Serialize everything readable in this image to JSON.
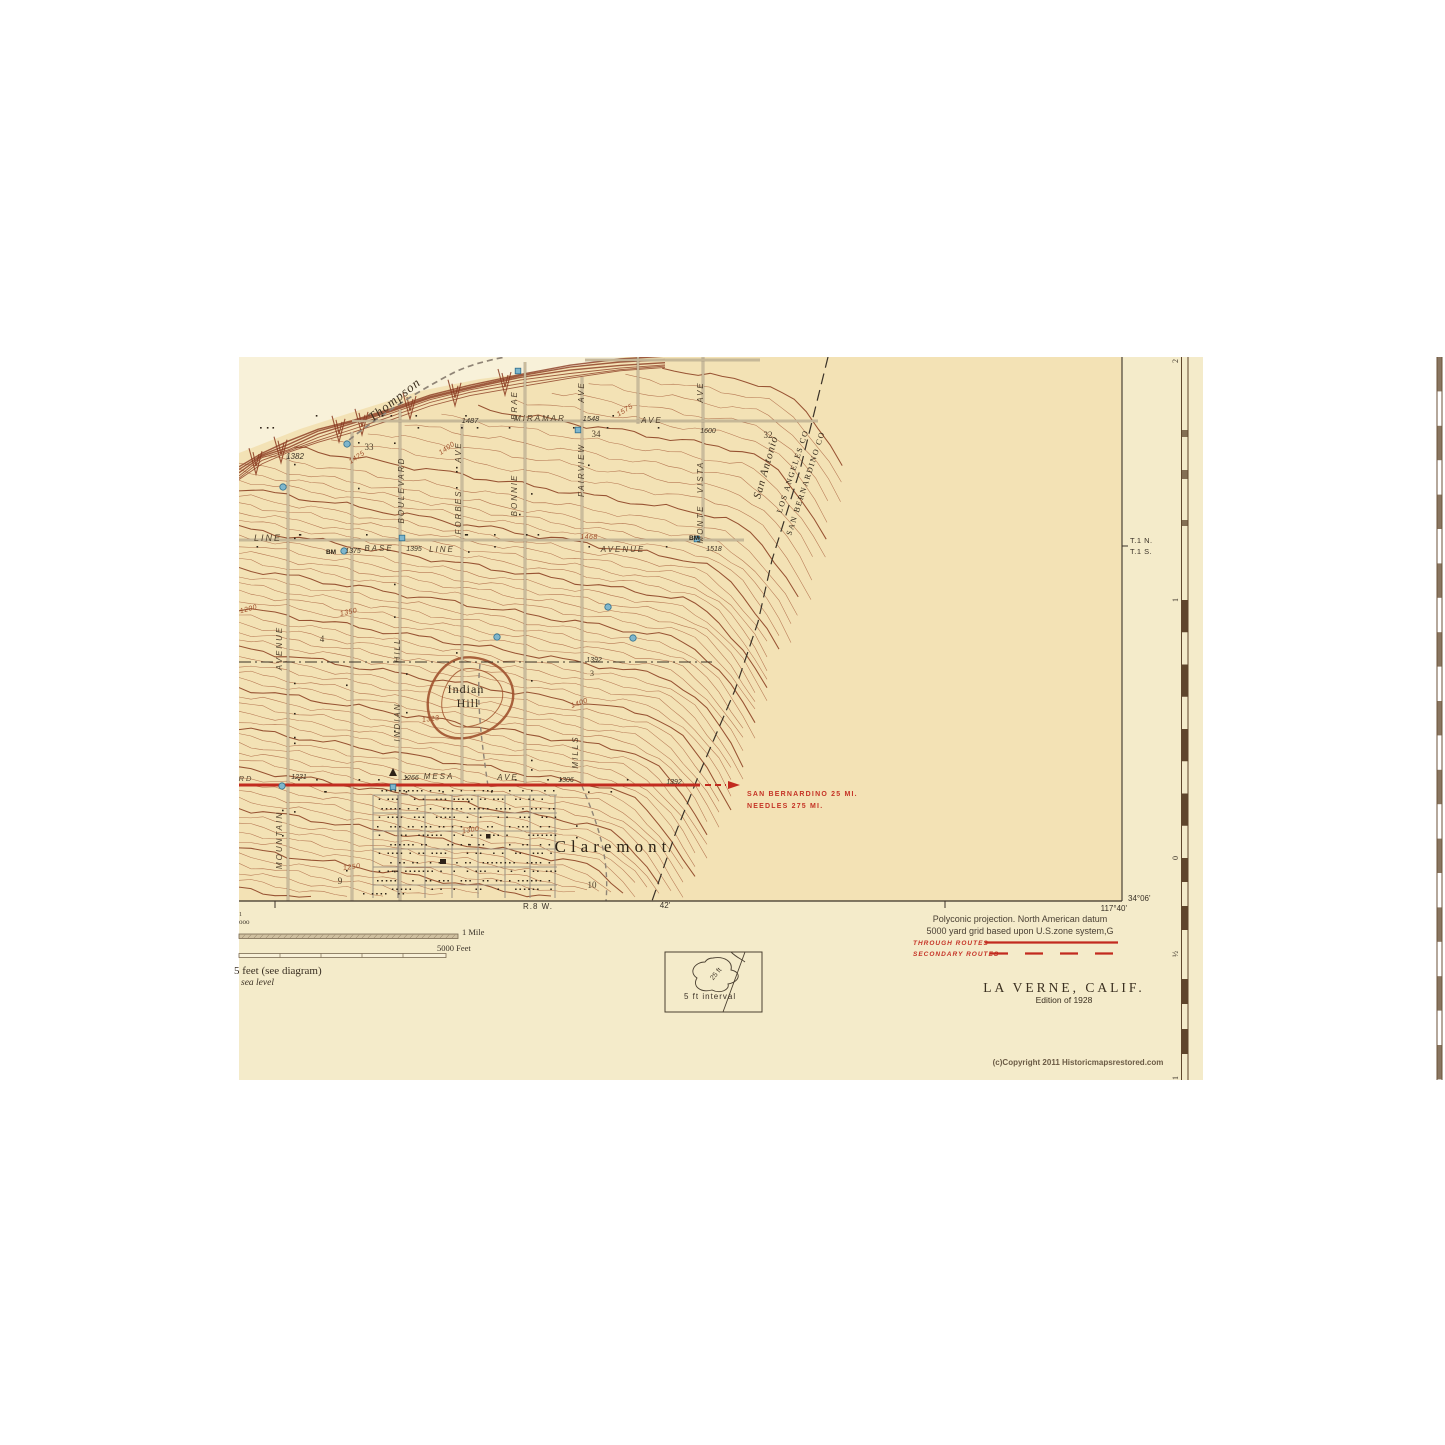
{
  "colors": {
    "page": "#ffffff",
    "sheet": "#f4ebca",
    "map_interior": "#f3e2b5",
    "pale_wash": "#f8f1d9",
    "contour": "#b06c49",
    "contour_index": "#8f4527",
    "escarpment": "#8a3a20",
    "road_gray": "#8f8476",
    "road_fill": "#f3e2b5",
    "ink": "#3a3228",
    "red_route": "#c22b1f",
    "red_text": "#c53326",
    "blue_fill": "#7fb6cc",
    "blue_stroke": "#2f6e8c",
    "ruler": "#5f452c"
  },
  "margin": {
    "projection_line1": "Polyconic projection. North American datum",
    "projection_line2": "5000 yard grid based upon U.S.zone system,G",
    "through_routes": "THROUGH ROUTES",
    "secondary_routes": "SECONDARY ROUTES",
    "title": "LA VERNE, CALIF.",
    "edition": "Edition of 1928",
    "copyright": "(c)Copyright 2011 Historicmapsrestored.com",
    "corner_lat": "34°06'",
    "corner_lon": "117°40'",
    "range_label": "R.8 W.",
    "minutes_label": "42'",
    "township_n": "T.1 N.",
    "township_s": "T.1 S.",
    "scale_mile_label": "1 Mile",
    "scale_feet_label": "5000 Feet",
    "contour_note": "5 feet (see diagram)",
    "datum_note": "sea level",
    "scale_fragment_top": "1",
    "scale_fragment": "ooo",
    "inset_blob_label": "25 ft",
    "inset_caption": "5 ft interval",
    "ruler_labels": [
      "2",
      "1",
      "0",
      "½",
      "1"
    ]
  },
  "map": {
    "labels": [
      {
        "t": "Thompson",
        "x": 397,
        "y": 403,
        "r": -38,
        "s": 13,
        "st": "water"
      },
      {
        "t": "San Antonio",
        "x": 769,
        "y": 468,
        "r": -74,
        "s": 11,
        "st": "water"
      },
      {
        "t": "LOS ANGELES CO",
        "x": 795,
        "y": 472,
        "r": -72,
        "s": 8,
        "st": "county"
      },
      {
        "t": "SAN BERNARDINO CO",
        "x": 808,
        "y": 484,
        "r": -72,
        "s": 8,
        "st": "county"
      },
      {
        "t": "Claremont",
        "x": 613,
        "y": 852,
        "r": 0,
        "s": 17,
        "st": "town"
      },
      {
        "t": "Indian",
        "x": 466,
        "y": 693,
        "r": 0,
        "s": 12,
        "st": "place"
      },
      {
        "t": "Hill",
        "x": 468,
        "y": 707,
        "r": 0,
        "s": 12,
        "st": "place"
      },
      {
        "t": "MIRAMAR",
        "x": 540,
        "y": 421,
        "r": 0,
        "s": 8,
        "st": "street"
      },
      {
        "t": "1548",
        "x": 591,
        "y": 421,
        "r": 0,
        "s": 7.5,
        "st": "elev"
      },
      {
        "t": "AVE",
        "x": 652,
        "y": 423,
        "r": 0,
        "s": 8,
        "st": "street"
      },
      {
        "t": "1487",
        "x": 470,
        "y": 423,
        "r": 0,
        "s": 7.5,
        "st": "elev"
      },
      {
        "t": "AVE",
        "x": 461,
        "y": 452,
        "r": -90,
        "s": 8,
        "st": "street"
      },
      {
        "t": "FORBES",
        "x": 461,
        "y": 512,
        "r": -90,
        "s": 8,
        "st": "street"
      },
      {
        "t": "BRAE",
        "x": 517,
        "y": 405,
        "r": -90,
        "s": 8,
        "st": "street"
      },
      {
        "t": "BONNIE",
        "x": 517,
        "y": 495,
        "r": -90,
        "s": 8,
        "st": "street"
      },
      {
        "t": "AVE",
        "x": 584,
        "y": 392,
        "r": -90,
        "s": 8,
        "st": "street"
      },
      {
        "t": "FAIRVIEW",
        "x": 584,
        "y": 470,
        "r": -90,
        "s": 8,
        "st": "street"
      },
      {
        "t": "AVE",
        "x": 703,
        "y": 392,
        "r": -90,
        "s": 8,
        "st": "street"
      },
      {
        "t": "VISTA",
        "x": 703,
        "y": 477,
        "r": -90,
        "s": 8,
        "st": "street"
      },
      {
        "t": "MONTE",
        "x": 703,
        "y": 524,
        "r": -90,
        "s": 8,
        "st": "street"
      },
      {
        "t": "BOULEVARD",
        "x": 404,
        "y": 490,
        "r": -90,
        "s": 8,
        "st": "street"
      },
      {
        "t": "HILL",
        "x": 400,
        "y": 650,
        "r": -90,
        "s": 8,
        "st": "street"
      },
      {
        "t": "INDIAN",
        "x": 400,
        "y": 722,
        "r": -90,
        "s": 8,
        "st": "street"
      },
      {
        "t": "AVENUE",
        "x": 282,
        "y": 648,
        "r": -90,
        "s": 8,
        "st": "street"
      },
      {
        "t": "MOUNTAIN",
        "x": 282,
        "y": 840,
        "r": -90,
        "s": 8,
        "st": "street"
      },
      {
        "t": "MILLS",
        "x": 578,
        "y": 752,
        "r": -90,
        "s": 8,
        "st": "street"
      },
      {
        "t": "LINE",
        "x": 268,
        "y": 541,
        "r": 0,
        "s": 9,
        "st": "street"
      },
      {
        "t": "BM",
        "x": 331,
        "y": 554,
        "r": 0,
        "s": 6.5,
        "st": "bm"
      },
      {
        "t": "1375",
        "x": 353,
        "y": 553,
        "r": 0,
        "s": 7,
        "st": "elev"
      },
      {
        "t": "BASE",
        "x": 379,
        "y": 551,
        "r": 0,
        "s": 8,
        "st": "street"
      },
      {
        "t": "1395",
        "x": 414,
        "y": 551,
        "r": 0,
        "s": 7,
        "st": "elev"
      },
      {
        "t": "LINE",
        "x": 442,
        "y": 552,
        "r": 0,
        "s": 8,
        "st": "street"
      },
      {
        "t": "AVENUE",
        "x": 623,
        "y": 552,
        "r": 0,
        "s": 8,
        "st": "street"
      },
      {
        "t": "BM",
        "x": 694,
        "y": 540,
        "r": 0,
        "s": 6.5,
        "st": "bm"
      },
      {
        "t": "1518",
        "x": 714,
        "y": 551,
        "r": 0,
        "s": 7,
        "st": "elev"
      },
      {
        "t": "1468",
        "x": 589,
        "y": 539,
        "r": 0,
        "s": 7,
        "st": "conlbl"
      },
      {
        "t": "33",
        "x": 369,
        "y": 450,
        "r": 0,
        "s": 9,
        "st": "sec"
      },
      {
        "t": "34",
        "x": 596,
        "y": 437,
        "r": 0,
        "s": 9,
        "st": "sec"
      },
      {
        "t": "32",
        "x": 768,
        "y": 438,
        "r": 0,
        "s": 9,
        "st": "sec"
      },
      {
        "t": "4",
        "x": 322,
        "y": 642,
        "r": 0,
        "s": 9,
        "st": "sec"
      },
      {
        "t": "9",
        "x": 340,
        "y": 884,
        "r": 0,
        "s": 9,
        "st": "sec"
      },
      {
        "t": "10",
        "x": 592,
        "y": 888,
        "r": 0,
        "s": 9,
        "st": "sec"
      },
      {
        "t": "3",
        "x": 592,
        "y": 676,
        "r": 0,
        "s": 8,
        "st": "sec"
      },
      {
        "t": "1382",
        "x": 295,
        "y": 459,
        "r": 0,
        "s": 8,
        "st": "elev"
      },
      {
        "t": "1392",
        "x": 594,
        "y": 662,
        "r": 0,
        "s": 7,
        "st": "elev"
      },
      {
        "t": "1600",
        "x": 708,
        "y": 433,
        "r": 0,
        "s": 7,
        "st": "elev"
      },
      {
        "t": "RD",
        "x": 246,
        "y": 781,
        "r": 0,
        "s": 7.5,
        "st": "street"
      },
      {
        "t": "1231",
        "x": 299,
        "y": 779,
        "r": 0,
        "s": 7,
        "st": "elev"
      },
      {
        "t": "1266",
        "x": 411,
        "y": 780,
        "r": 0,
        "s": 7,
        "st": "elev"
      },
      {
        "t": "MESA",
        "x": 439,
        "y": 779,
        "r": 0,
        "s": 8,
        "st": "street"
      },
      {
        "t": "AVE",
        "x": 508,
        "y": 780,
        "r": 0,
        "s": 8,
        "st": "street"
      },
      {
        "t": "1306",
        "x": 566,
        "y": 782,
        "r": 0,
        "s": 7,
        "st": "elev"
      },
      {
        "t": "1392",
        "x": 674,
        "y": 784,
        "r": 0,
        "s": 7,
        "st": "elev"
      },
      {
        "t": "SAN BERNARDINO 25 MI.",
        "x": 747,
        "y": 796,
        "r": 0,
        "s": 7,
        "st": "red",
        "a": "start"
      },
      {
        "t": "NEEDLES 275 MI.",
        "x": 747,
        "y": 808,
        "r": 0,
        "s": 7,
        "st": "red",
        "a": "start"
      },
      {
        "t": "1323",
        "x": 431,
        "y": 721,
        "r": -8,
        "s": 7,
        "st": "conlbl"
      },
      {
        "t": "1425",
        "x": 358,
        "y": 459,
        "r": -35,
        "s": 7,
        "st": "conlbl"
      },
      {
        "t": "1400",
        "x": 448,
        "y": 450,
        "r": -35,
        "s": 7,
        "st": "conlbl"
      },
      {
        "t": "1575",
        "x": 626,
        "y": 412,
        "r": -32,
        "s": 7,
        "st": "conlbl"
      },
      {
        "t": "1200",
        "x": 249,
        "y": 611,
        "r": -15,
        "s": 7,
        "st": "conlbl"
      },
      {
        "t": "1350",
        "x": 349,
        "y": 614,
        "r": -12,
        "s": 7,
        "st": "conlbl"
      },
      {
        "t": "1400",
        "x": 580,
        "y": 705,
        "r": -20,
        "s": 7,
        "st": "conlbl"
      },
      {
        "t": "1300",
        "x": 471,
        "y": 832,
        "r": -10,
        "s": 7,
        "st": "conlbl"
      },
      {
        "t": "1250",
        "x": 352,
        "y": 869,
        "r": -8,
        "s": 7,
        "st": "conlbl"
      }
    ]
  }
}
